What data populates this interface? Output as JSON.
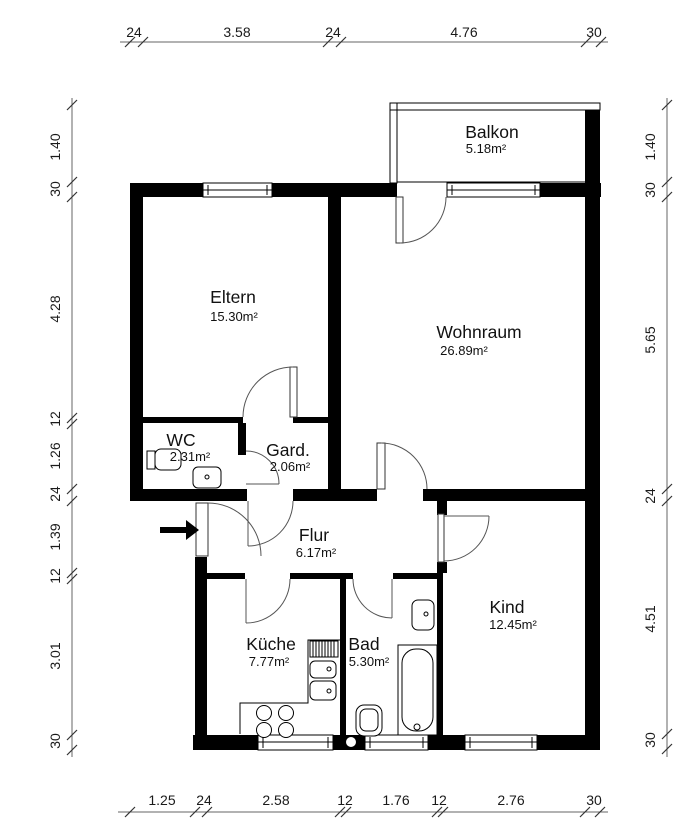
{
  "plan": {
    "rooms": [
      {
        "id": "balkon",
        "name": "Balkon",
        "area": "5.18m²"
      },
      {
        "id": "eltern",
        "name": "Eltern",
        "area": "15.30m²"
      },
      {
        "id": "wohnraum",
        "name": "Wohnraum",
        "area": "26.89m²"
      },
      {
        "id": "wc",
        "name": "WC",
        "area": "2.31m²"
      },
      {
        "id": "gard",
        "name": "Gard.",
        "area": "2.06m²"
      },
      {
        "id": "flur",
        "name": "Flur",
        "area": "6.17m²"
      },
      {
        "id": "kueche",
        "name": "Küche",
        "area": "7.77m²"
      },
      {
        "id": "bad",
        "name": "Bad",
        "area": "5.30m²"
      },
      {
        "id": "kind",
        "name": "Kind",
        "area": "12.45m²"
      }
    ],
    "dimensions": {
      "top": [
        "24",
        "3.58",
        "24",
        "4.76",
        "30"
      ],
      "bottom": [
        "1.25",
        "24",
        "2.58",
        "12",
        "1.76",
        "12",
        "2.76",
        "30"
      ],
      "left": [
        "1.40",
        "30",
        "4.28",
        "12",
        "1.26",
        "24",
        "1.39",
        "12",
        "3.01",
        "30"
      ],
      "right": [
        "1.40",
        "30",
        "5.65",
        "24",
        "4.51",
        "30"
      ]
    },
    "colors": {
      "wall": "#000000",
      "background": "#ffffff",
      "line": "#555555"
    }
  }
}
